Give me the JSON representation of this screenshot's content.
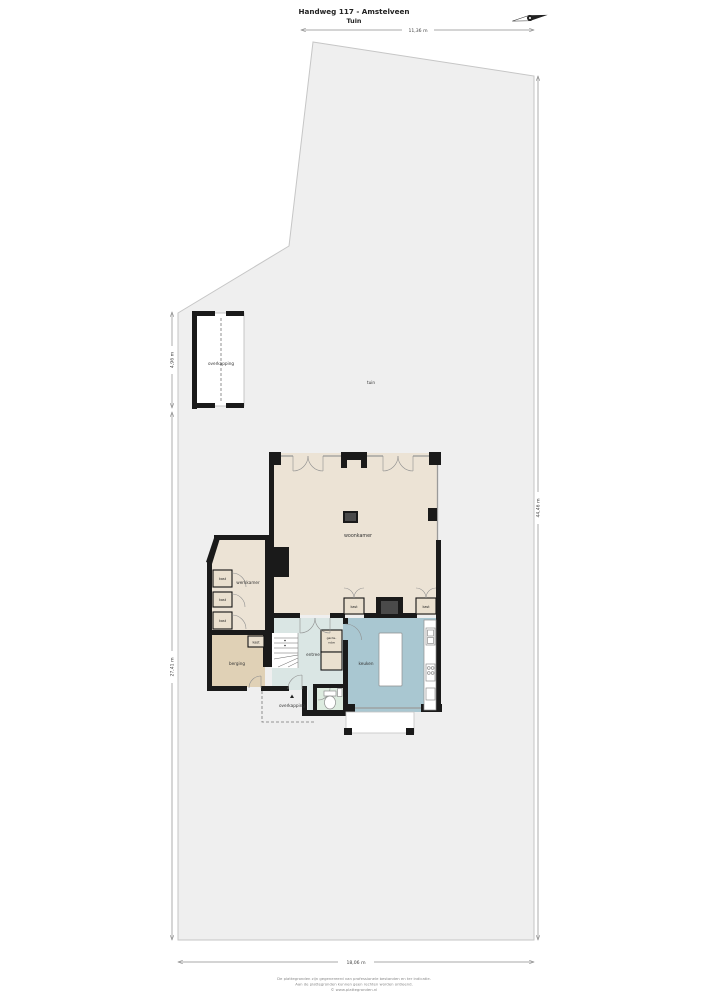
{
  "header": {
    "title": "Handweg 117 - Amstelveen",
    "subtitle": "Tuin"
  },
  "dimensions": {
    "top": "11,36 m",
    "right": "44,46 m",
    "left_upper": "4,96 m",
    "left_lower": "27,41 m",
    "bottom": "18,06 m"
  },
  "labels": {
    "tuin": "tuin",
    "overkapping": "overkapping",
    "woonkamer": "woonkamer",
    "werkkamer": "werkkamer",
    "berging": "berging",
    "entree": "entree",
    "keuken": "keuken",
    "kast": "kast",
    "garde_robe_line1": "garde-",
    "garde_robe_line2": "robe"
  },
  "footer": {
    "line1": "De plattegronden zijn gegenereerd van professionele bestanden en ter indicatie.",
    "line2": "Aan de plattegronden kunnen geen rechten worden ontleend.",
    "line3": "© www.plattegronden.nl"
  },
  "colors": {
    "parcel": "#efefef",
    "room_beige": "#ece3d5",
    "berging_tan": "#e0d1b6",
    "keuken_blue": "#a9c7d1",
    "entree_blue": "#dae6e4",
    "toilet_green": "#dcebdf",
    "kast_fill": "#eae0cf",
    "wall": "#1a1a1a"
  }
}
